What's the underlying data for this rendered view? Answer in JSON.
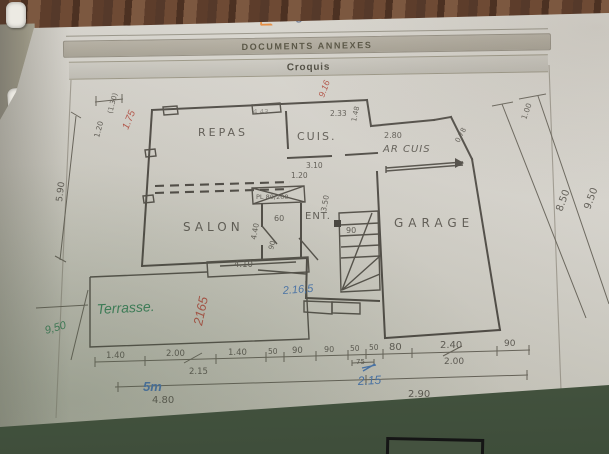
{
  "header": {
    "logo": {
      "i": "i",
      "rest": "Diag.com"
    },
    "bar1": "DOCUMENTS ANNEXES",
    "bar2": "Croquis"
  },
  "plan": {
    "rooms": {
      "repas": "REPAS",
      "cuis": "CUIS.",
      "ar_cuis": "AR CUIS",
      "ent": "ENT.",
      "salon": "SALON",
      "garage": "GARAGE",
      "terrasse": "Terrasse."
    },
    "printed_dims": {
      "top_443": "4.43",
      "top_233": "2.33",
      "right_148": "1.48",
      "arcuis_280": "2.80",
      "diag_078": "0.78",
      "cuis_310": "3.10",
      "ent_120": "1.20",
      "stairs_350": "3.50",
      "stairs_90": "90",
      "closet": "PL 80/200",
      "vest_60": "60",
      "vest_440": "4.40",
      "door_90": "90",
      "salon_410": "4.10",
      "left_120": "1.20",
      "left_130": "(1.30)",
      "left_590": "5.90",
      "right_100": "1.00",
      "right_850": "8.50",
      "right_950": "9.50",
      "bottom_480": "4.80",
      "bottom_290": "2.90"
    },
    "bottom_row": [
      "1.40",
      "2.00",
      "1.40",
      "50",
      "90",
      "90",
      "50",
      "50",
      "80",
      "2.40",
      "90"
    ],
    "bottom_sub": {
      "s215": "2.15",
      "s75": "75",
      "s200": "2.00"
    },
    "handwritten": {
      "red_175": "1.75",
      "red_916": "9.16",
      "red_2165": "2165",
      "green_950": "9,50",
      "blue_2165": "2.16,5",
      "blue_5m": "5m",
      "blue_215": "2.15"
    }
  }
}
